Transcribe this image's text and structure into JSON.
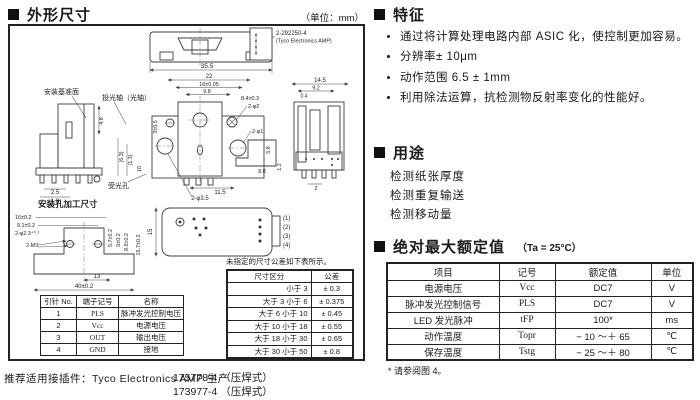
{
  "outline": {
    "title": "外形尺寸",
    "unit_note": "（单位：mm）"
  },
  "features": {
    "title": "特征",
    "items": [
      "通过将计算处理电路内部 ASIC 化，使控制更加容易。",
      "分辨率± 10μm",
      "动作范围 6.5 ± 1mm",
      "利用除法运算，抗检测物反射率变化的性能好。"
    ]
  },
  "applications": {
    "title": "用途",
    "items": [
      "检测纸张厚度",
      "检测重复输送",
      "检测移动量"
    ]
  },
  "ratings": {
    "title": "绝对最大额定值",
    "condition": "（Ta = 25°C）",
    "headers": [
      "项目",
      "记号",
      "额定值",
      "单位"
    ],
    "rows": [
      [
        "电源电压",
        "Vcc",
        "DC7",
        "V"
      ],
      [
        "脉冲发光控制信号",
        "PLS",
        "DC7",
        "V"
      ],
      [
        "LED 发光脉冲",
        "tFP",
        "100*",
        "ms"
      ],
      [
        "动作温度",
        "Topr",
        "− 10 ～＋ 65",
        "℃"
      ],
      [
        "保存温度",
        "Tstg",
        "− 25 ～＋ 80",
        "℃"
      ]
    ],
    "footnote": "* 请参阅图 4。"
  },
  "pin_table": {
    "headers": [
      "引针 No.",
      "端子记号",
      "名称"
    ],
    "rows": [
      [
        "1",
        "PLS",
        "脉冲发光控制电压"
      ],
      [
        "2",
        "Vcc",
        "电源电压"
      ],
      [
        "3",
        "OUT",
        "输出电压"
      ],
      [
        "4",
        "GND",
        "接地"
      ]
    ]
  },
  "tolerance": {
    "note": "未指定的尺寸公差如下表所示。",
    "headers": [
      "尺寸区分",
      "公差"
    ],
    "rows": [
      [
        "小于 3",
        "± 0.3"
      ],
      [
        "大于 3 小于 6",
        "± 0.375"
      ],
      [
        "大于 6 小于 10",
        "± 0.45"
      ],
      [
        "大于 10 小于 18",
        "± 0.55"
      ],
      [
        "大于 18 小于 30",
        "± 0.65"
      ],
      [
        "大于 30 小于 50",
        "± 0.8"
      ]
    ]
  },
  "connector": {
    "recommend": "推荐适用接插件：Tyco Electronics AMP 生产",
    "parts": [
      "175778-4 （压焊式）",
      "173977-4 （压焊式）"
    ]
  },
  "drawing": {
    "part_no": "2-292250-4",
    "maker": "(Tyco Electronics AMP)",
    "mount_ref": "安装基准面",
    "axis": "投光轴（光轴）",
    "recv": "受光孔",
    "mount_title": "安装孔加工尺寸",
    "pins": [
      "(1)",
      "(2)",
      "(3)",
      "(4)"
    ],
    "d355": "35.5",
    "d22": "22",
    "d16": "16±0.05",
    "d98": "9.8",
    "d84": "8.4±0.3",
    "p2": "2-φ2",
    "p1": "2-φ1",
    "p35": "2-φ3.5",
    "d115": "11.5",
    "d88": "8.8",
    "d58": "5.8",
    "d12": "1.2",
    "d305": "3±0.5",
    "d145": "14.5",
    "d92": "9.2",
    "d04": "0.4",
    "d2": "2",
    "d48": "4.8",
    "d25": "2.5",
    "d18": "1.8",
    "d63": "(6.3)",
    "d13p": "(1.3)",
    "d10": "10",
    "d15": "15",
    "m16": "16±0.2",
    "m91": "9.1±0.2",
    "m23": "2-φ2.3⁺⁰·¹",
    "m3": "2-M3",
    "m57": "5.7±0.2",
    "m5": "5±0.2",
    "m85": "8.5±0.2",
    "m157": "15.7±0.2",
    "m13": "13",
    "m40": "40±0.2"
  }
}
